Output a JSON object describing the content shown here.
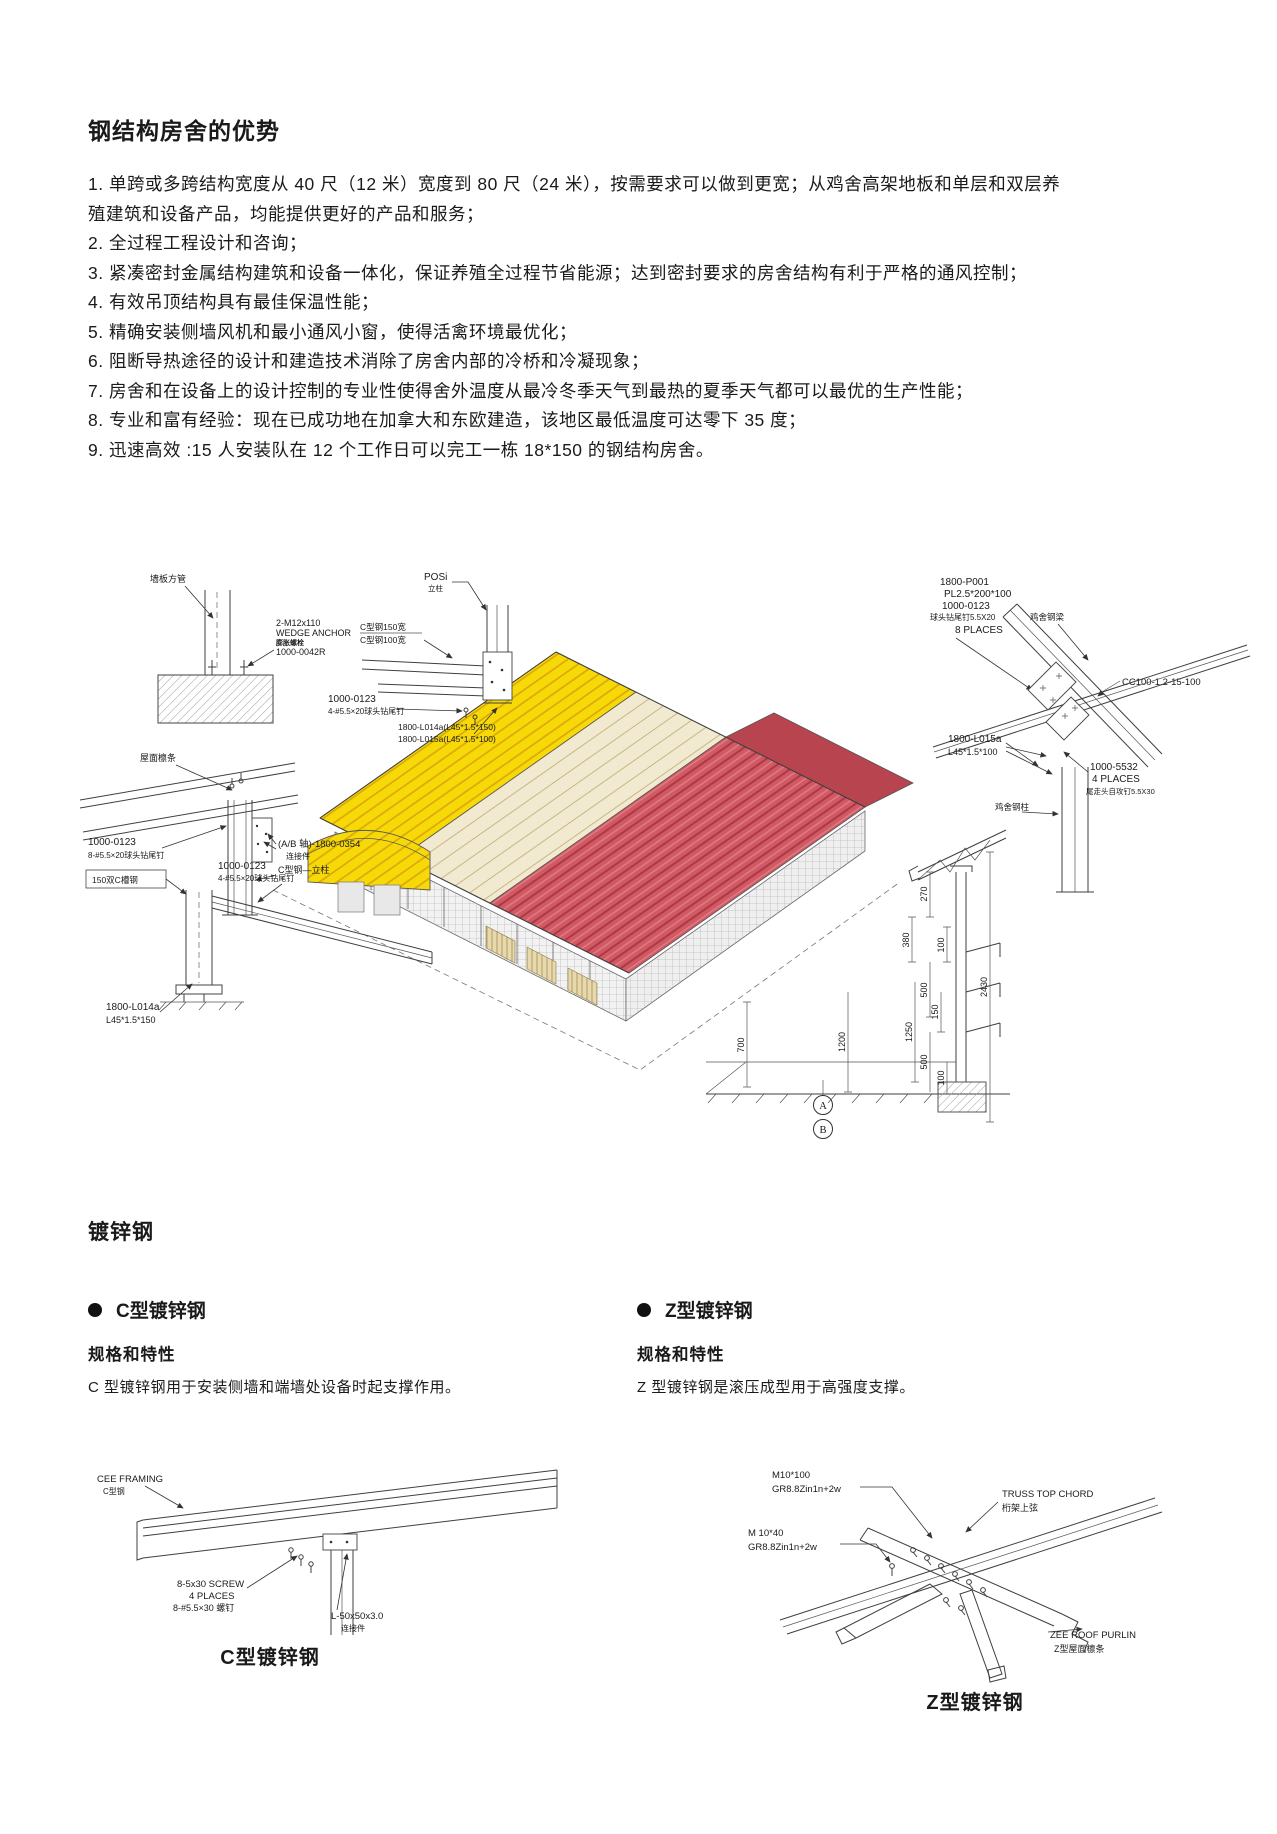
{
  "header": {
    "title": "钢结构房舍的优势"
  },
  "advantages": [
    "1. 单跨或多跨结构宽度从 40 尺（12 米）宽度到 80 尺（24 米），按需要求可以做到更宽；从鸡舍高架地板和单层和双层养殖建筑和设备产品，均能提供更好的产品和服务；",
    "2. 全过程工程设计和咨询；",
    "3. 紧凑密封金属结构建筑和设备一体化，保证养殖全过程节省能源；达到密封要求的房舍结构有利于严格的通风控制；",
    "4. 有效吊顶结构具有最佳保温性能；",
    "5. 精确安装侧墙风机和最小通风小窗，使得活禽环境最优化；",
    "6. 阻断导热途径的设计和建造技术消除了房舍内部的冷桥和冷凝现象；",
    "7. 房舍和在设备上的设计控制的专业性使得舍外温度从最冷冬季天气到最热的夏季天气都可以最优的生产性能；",
    "8. 专业和富有经验：现在已成功地在加拿大和东欧建造，该地区最低温度可达零下 35 度；",
    "9. 迅速高效 :15 人安装队在 12 个工作日可以完工一栋 18*150 的钢结构房舍。"
  ],
  "main_diagram": {
    "labels": {
      "wall_tube": "墙板方管",
      "wedge1": "2-M12x110",
      "wedge2": "WEDGE ANCHOR",
      "wedge3": "膨胀螺栓",
      "wedge4": "1000-0042R",
      "posi": "POSi",
      "posi_sub": "立柱",
      "c150": "C型钢150宽",
      "c100": "C型钢100宽",
      "s1a": "1000-0123",
      "s1b": "4-#5.5×20球头钻尾钉",
      "ang1": "1800-L014a(L45*1.5*150)",
      "ang2": "1800-L015a(L45*1.5*100)",
      "p1": "1800-P001",
      "p2": "PL2.5*200*100",
      "p3": "1000-0123",
      "p4": "球头钻尾钉5.5X20",
      "p5": "8 PLACES",
      "beam": "鸡舍钢梁",
      "cc": "CC100-1.2-15-100",
      "l015a": "1800-L015a",
      "l015b": "L45*1.5*100",
      "q1": "1000-5532",
      "q2": "4 PLACES",
      "q3": "尾走头自攻钉5.5X30",
      "col": "鸡舍钢柱",
      "purlin": "屋面檩条",
      "s2a": "1000-0123",
      "s2b": "8-#5.5×20球头钻尾钉",
      "ab1": "(A/B 轴)-1800-0354",
      "ab2": "连接件",
      "cpost": "C型钢—立柱",
      "cc150": "150双C槽钢",
      "s3a": "1000-0123",
      "s3b": "4-#5.5×20球头钻尾钉",
      "l014a": "1800-L014a",
      "l014b": "L45*1.5*150"
    },
    "dims": [
      "270",
      "380",
      "100",
      "500",
      "150",
      "1250",
      "1200",
      "500",
      "100",
      "2430",
      "700"
    ],
    "markers": [
      "A",
      "B"
    ]
  },
  "galvanized": {
    "heading": "镀锌钢",
    "c": {
      "title": "C型镀锌钢",
      "spec_heading": "规格和特性",
      "spec_text": "C 型镀锌钢用于安装侧墙和端墙处设备时起支撑作用。"
    },
    "z": {
      "title": "Z型镀锌钢",
      "spec_heading": "规格和特性",
      "spec_text": "Z 型镀锌钢是滚压成型用于高强度支撑。"
    }
  },
  "c_detail": {
    "f1": "CEE FRAMING",
    "f2": "C型钢",
    "s1": "8-5x30 SCREW",
    "s2": "4 PLACES",
    "s3": "8-#5.5×30 螺钉",
    "a1": "L-50x50x3.0",
    "a2": "连接件",
    "caption": "C型镀锌钢"
  },
  "z_detail": {
    "m1a": "M10*100",
    "m1b": "GR8.8Zin1n+2w",
    "m2a": "M 10*40",
    "m2b": "GR8.8Zin1n+2w",
    "t1": "TRUSS TOP CHORD",
    "t2": "桁架上弦",
    "z1": "ZEE ROOF PURLIN",
    "z2": "Z型屋面檩条",
    "caption": "Z型镀锌钢"
  },
  "colors": {
    "roof_red": "#d25863",
    "panel_yellow": "#f7d908",
    "deck_cream": "#f1ead0"
  }
}
